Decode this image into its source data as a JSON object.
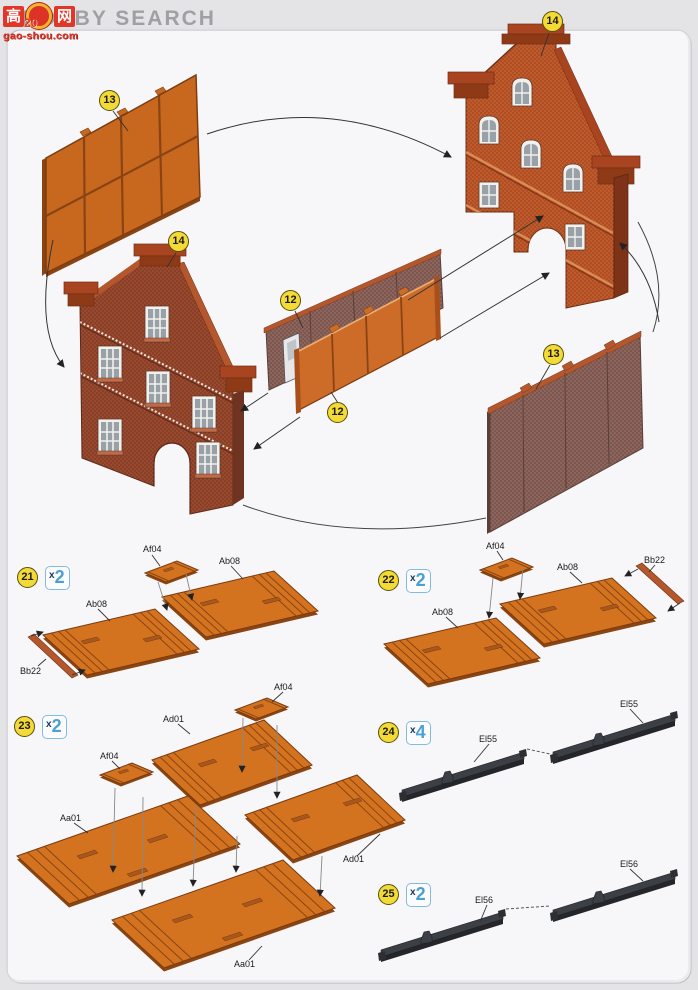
{
  "header": {
    "brand": "HOBBY SEARCH",
    "watermark": {
      "char_left": "高",
      "char_right": "网",
      "number": "20",
      "site": "gao-shou.com"
    }
  },
  "assembly": {
    "description": "exploded view of four building wall sections joined in a loop",
    "callouts": [
      "13",
      "14",
      "14",
      "12",
      "12",
      "13"
    ]
  },
  "steps": [
    {
      "num": "21",
      "qty_x": "x",
      "qty_n": "2",
      "labels": [
        "Af04",
        "Ab08",
        "Ab08",
        "Bb22"
      ]
    },
    {
      "num": "22",
      "qty_x": "x",
      "qty_n": "2",
      "labels": [
        "Af04",
        "Ab08",
        "Ab08",
        "Bb22"
      ]
    },
    {
      "num": "23",
      "qty_x": "x",
      "qty_n": "2",
      "labels": [
        "Af04",
        "Ad01",
        "Af04",
        "Aa01",
        "Ad01",
        "Aa01"
      ]
    },
    {
      "num": "24",
      "qty_x": "x",
      "qty_n": "4",
      "labels": [
        "El55",
        "El55"
      ]
    },
    {
      "num": "25",
      "qty_x": "x",
      "qty_n": "2",
      "labels": [
        "El56",
        "El56"
      ]
    }
  ],
  "colors": {
    "floor_orange": "#d4731f",
    "panel_orange": "#cd6c28",
    "brick_red": "#c05a2b",
    "brick_dark": "#99492e",
    "wall_gray_brown": "#8d655c",
    "rail_black": "#3c3f45",
    "callout_yellow": "#f3da35",
    "badge_blue": "#4a9fd4",
    "watermark_red": "#e23728"
  }
}
